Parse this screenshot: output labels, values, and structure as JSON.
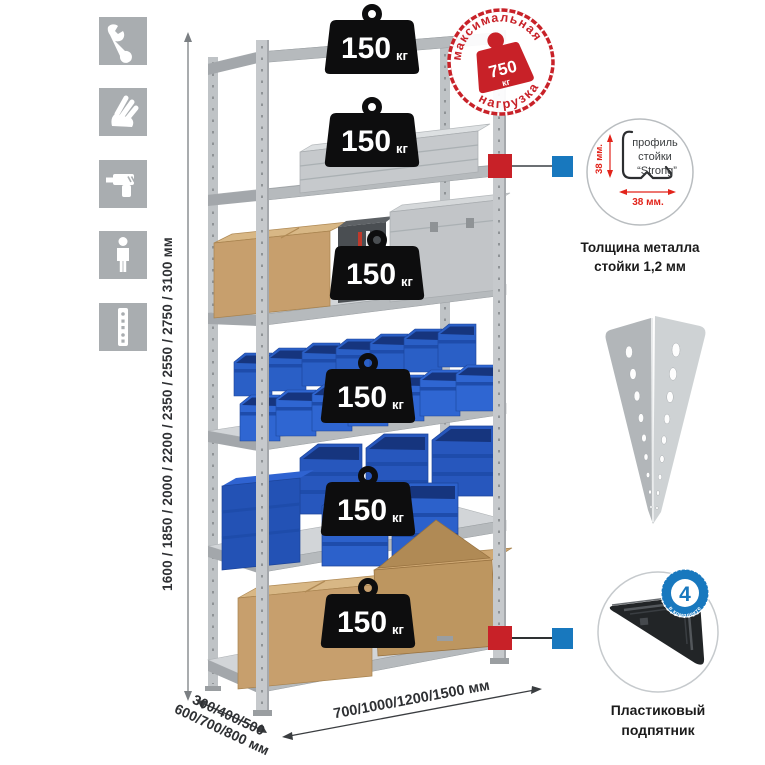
{
  "sidebar": {
    "icons": [
      {
        "name": "wrench"
      },
      {
        "name": "gloves"
      },
      {
        "name": "drill"
      },
      {
        "name": "person"
      },
      {
        "name": "upright-profile"
      }
    ]
  },
  "rack": {
    "load_badge": {
      "value": "150",
      "unit": "кг"
    }
  },
  "stamp": {
    "arc_top": "максимальная",
    "arc_bottom": "нагрузка",
    "value": "750",
    "unit": "кг"
  },
  "dimensions": {
    "height": "1600 / 1850 / 2000 / 2200 / 2350 / 2550 / 2750 / 3100 мм",
    "depth_line1": "300/400/500",
    "depth_line2": "600/700/800 мм",
    "width": "700/1000/1200/1500 мм"
  },
  "profile_detail": {
    "line1": "профиль",
    "line2": "стойки",
    "line3": "“Strong”",
    "dim_v": "38 мм.",
    "dim_h": "38 мм.",
    "caption1": "Толщина металла",
    "caption2": "стойки 1,2 мм"
  },
  "foot_detail": {
    "badge_value": "4",
    "badge_ring": "в комплекте",
    "caption1": "Пластиковый",
    "caption2": "подпятник"
  },
  "colors": {
    "accent_red": "#c82128",
    "accent_blue": "#1878be",
    "bin_blue": "#2a5fc6",
    "metal_gray": "#c3c7ca",
    "icon_gray": "#a9adb0",
    "cardboard": "#c79f6d"
  }
}
